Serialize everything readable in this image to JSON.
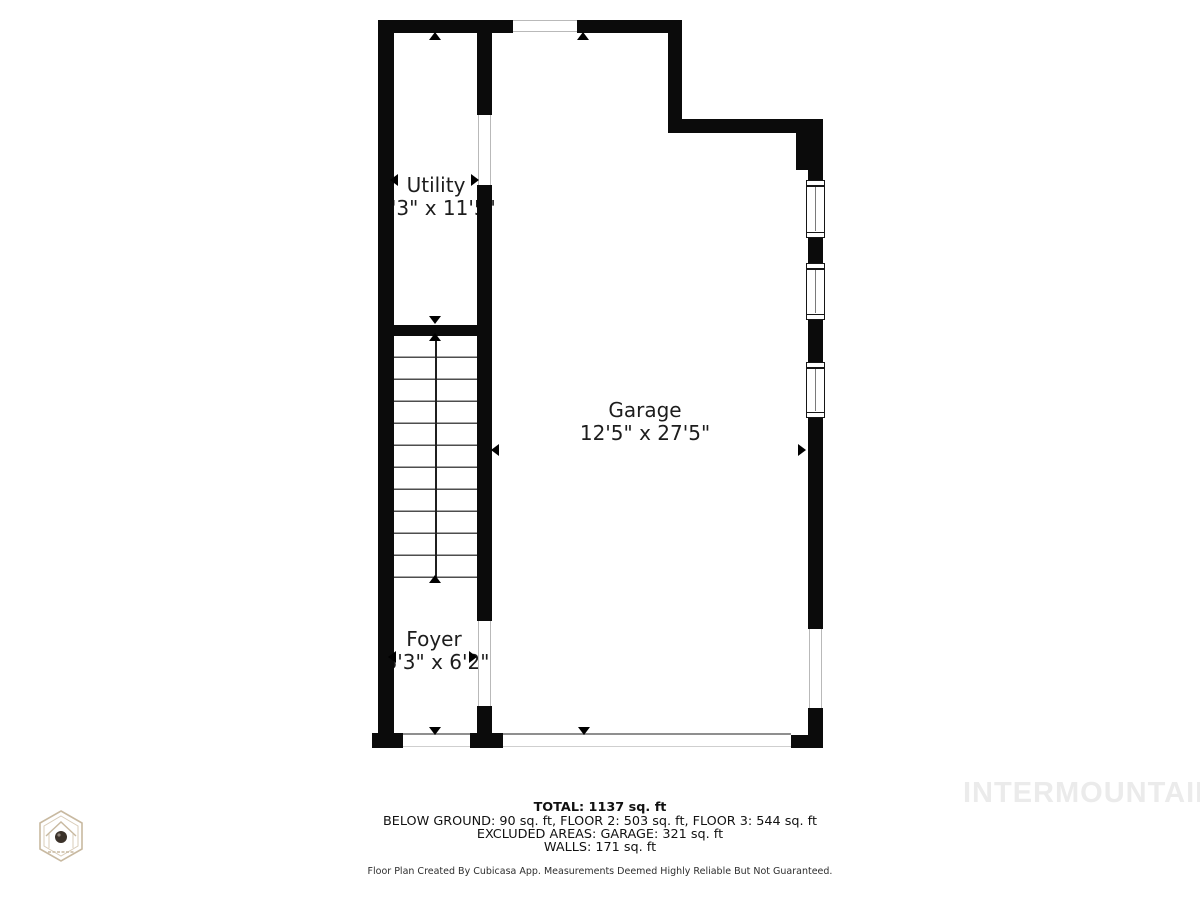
{
  "plan": {
    "rooms": [
      {
        "name": "Utility",
        "dims": "3'3\" x 11'5\""
      },
      {
        "name": "Garage",
        "dims": "12'5\" x 27'5\""
      },
      {
        "name": "Foyer",
        "dims": "3'3\" x 6'2\""
      }
    ]
  },
  "summary": {
    "total": "TOTAL: 1137 sq. ft",
    "line2": "BELOW GROUND: 90 sq. ft, FLOOR 2: 503 sq. ft, FLOOR 3: 544 sq. ft",
    "line3": "EXCLUDED AREAS: GARAGE: 321 sq. ft",
    "line4": "WALLS: 171 sq. ft"
  },
  "disclaimer": "Floor Plan Created By Cubicasa App. Measurements Deemed Highly Reliable But Not Guaranteed.",
  "watermark": "INTERMOUNTAIN",
  "colors": {
    "wall": "#0b0b0b",
    "tread_line": "#4e4e4e",
    "watermark_gray": "#ebebeb",
    "logo_tan": "#c8b9a0"
  }
}
